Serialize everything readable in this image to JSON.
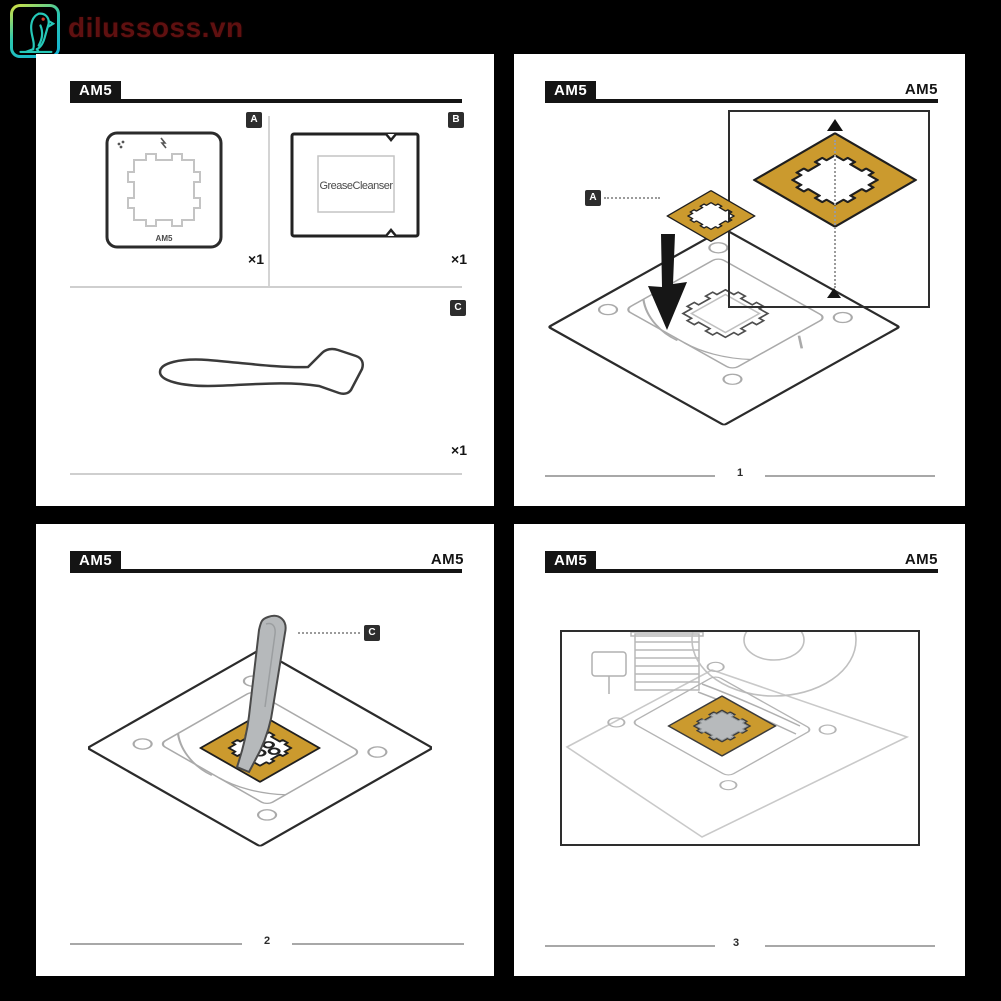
{
  "watermark": {
    "text": "dilussoss.vn",
    "icon": "parrot-icon"
  },
  "colors": {
    "background": "#000000",
    "panel": "#ffffff",
    "ink": "#161616",
    "frame_gold": "#cb9a2e",
    "line_light": "#c4c4c4",
    "spatula_gray": "#b6b9bb",
    "watermark_text": "#5f1010",
    "watermark_teal": "#25c8b8",
    "watermark_yellow": "#dde23b"
  },
  "panels": {
    "parts": {
      "header_badge": "AM5",
      "items": [
        {
          "label": "A",
          "name": "am5-mounting-frame",
          "engraving": "AM5",
          "qty": "×1"
        },
        {
          "label": "B",
          "name": "grease-cleanser-sachet",
          "text": "GreaseCleanser",
          "qty": "×1"
        },
        {
          "label": "C",
          "name": "paste-spreader",
          "qty": "×1"
        }
      ]
    },
    "step1": {
      "header_badge": "AM5",
      "header_right": "AM5",
      "callout": "A",
      "step_number": "1"
    },
    "step2": {
      "header_badge": "AM5",
      "header_right": "AM5",
      "callout": "C",
      "step_number": "2"
    },
    "step3": {
      "header_badge": "AM5",
      "header_right": "AM5",
      "step_number": "3"
    }
  }
}
